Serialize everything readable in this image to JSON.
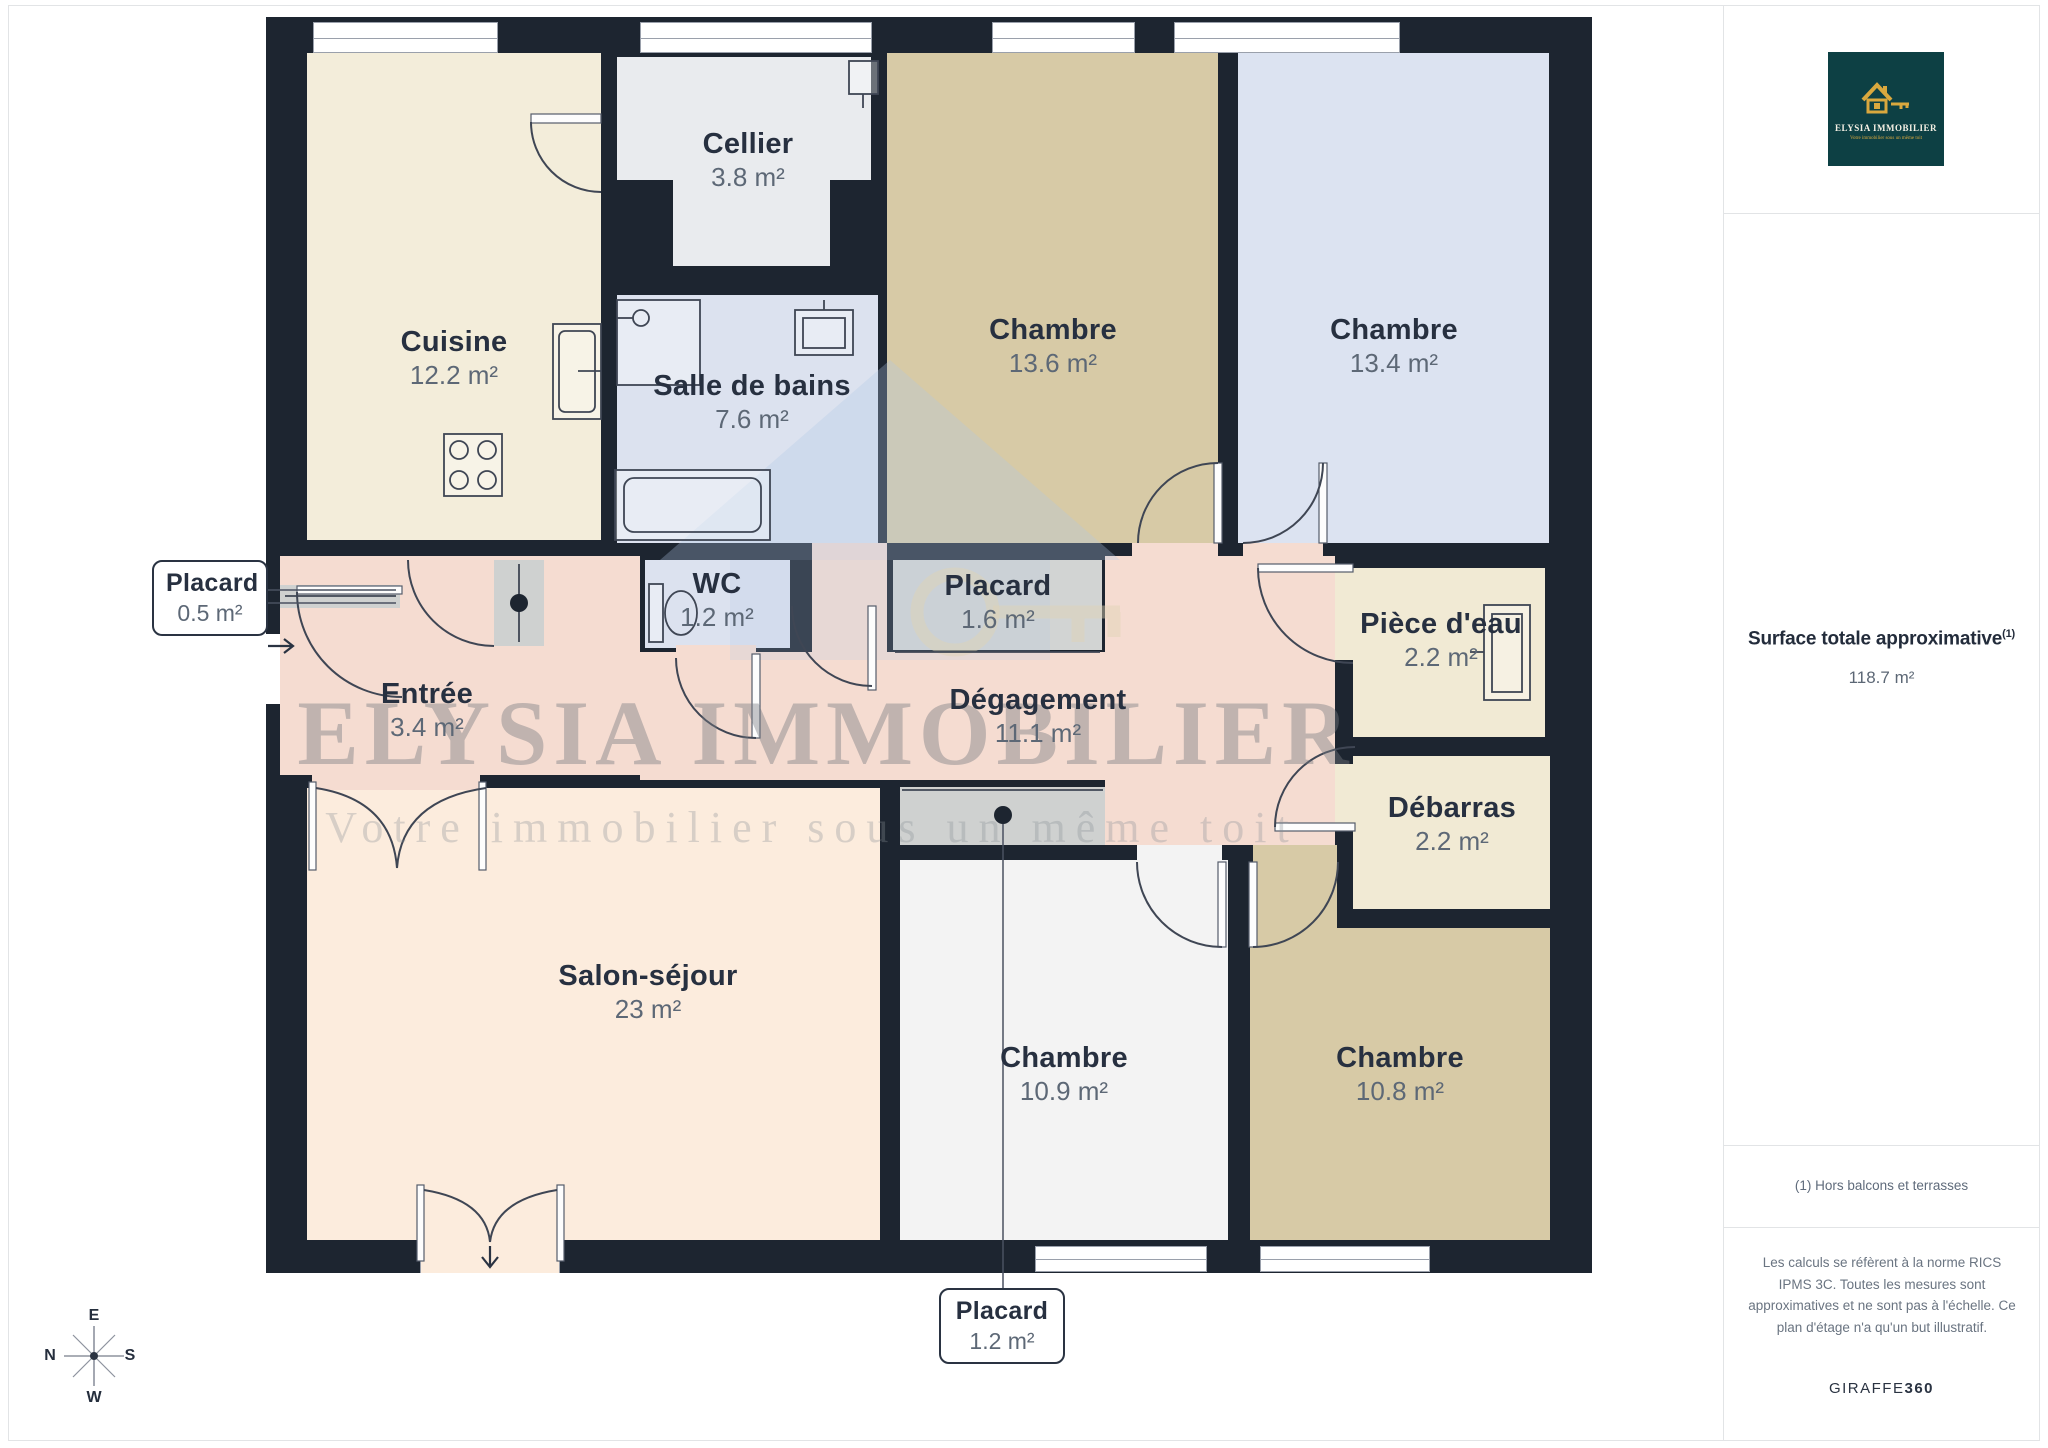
{
  "plan": {
    "watermark": {
      "title": "ELYSIA IMMOBILIER",
      "tagline": "Votre immobilier sous un même toit"
    },
    "rooms": [
      {
        "id": "cuisine",
        "name": "Cuisine",
        "area": "12.2 m²"
      },
      {
        "id": "cellier",
        "name": "Cellier",
        "area": "3.8 m²"
      },
      {
        "id": "salle-de-bains",
        "name": "Salle de bains",
        "area": "7.6 m²"
      },
      {
        "id": "wc",
        "name": "WC",
        "area": "1.2 m²"
      },
      {
        "id": "placard-haut",
        "name": "Placard",
        "area": "1.6 m²"
      },
      {
        "id": "chambre-1",
        "name": "Chambre",
        "area": "13.6 m²"
      },
      {
        "id": "chambre-2",
        "name": "Chambre",
        "area": "13.4 m²"
      },
      {
        "id": "piece-d-eau",
        "name": "Pièce d'eau",
        "area": "2.2 m²"
      },
      {
        "id": "degagement",
        "name": "Dégagement",
        "area": "11.1 m²"
      },
      {
        "id": "debarras",
        "name": "Débarras",
        "area": "2.2 m²"
      },
      {
        "id": "entree",
        "name": "Entrée",
        "area": "3.4 m²"
      },
      {
        "id": "salon-sejour",
        "name": "Salon-séjour",
        "area": "23 m²"
      },
      {
        "id": "chambre-3",
        "name": "Chambre",
        "area": "10.9 m²"
      },
      {
        "id": "chambre-4",
        "name": "Chambre",
        "area": "10.8 m²"
      }
    ],
    "callouts": [
      {
        "id": "placard-entree",
        "name": "Placard",
        "area": "0.5 m²"
      },
      {
        "id": "placard-bas",
        "name": "Placard",
        "area": "1.2 m²"
      }
    ],
    "compass": {
      "top": "E",
      "left": "N",
      "right": "S",
      "bottom": "W"
    },
    "colors": {
      "wall": "#1d2530",
      "cuisine": "#f3edda",
      "cellier": "#e9ebee",
      "bath": "#dce2ef",
      "bedroom_tan": "#d7caa6",
      "bedroom_blue": "#dce3f1",
      "closet": "#d2d4d3",
      "corridor": "#f5dcd1",
      "utility": "#f1ead4",
      "living": "#fcecdd",
      "bedroom_white": "#f3f3f3",
      "strip": "#cfd1d0",
      "label_dark": "#273040",
      "label_gray": "#5d6876",
      "logo_bg": "#0d4044",
      "logo_gold": "#d9a83e",
      "border": "#e2e4e6"
    }
  },
  "sidebar": {
    "logo": {
      "brand": "ELYSIA IMMOBILIER",
      "tagline": "Votre immobilier sous un même toit"
    },
    "surface": {
      "label": "Surface totale approximative",
      "footnote_marker": "(1)",
      "value": "118.7 m²"
    },
    "footnote": "(1) Hors balcons et terrasses",
    "disclaimer": "Les calculs se réfèrent à la norme RICS IPMS 3C. Toutes les mesures sont approximatives et ne sont pas à l'échelle. Ce plan d'étage n'a qu'un but illustratif.",
    "credit": {
      "brand": "GIRAFFE",
      "suffix": "360"
    }
  }
}
